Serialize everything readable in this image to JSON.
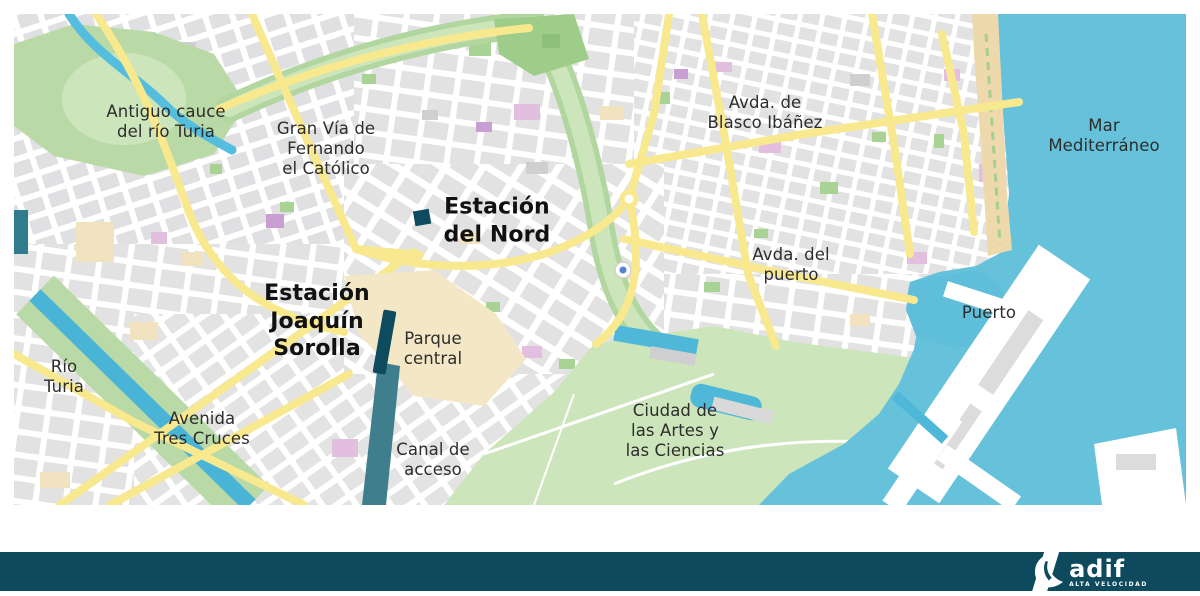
{
  "map": {
    "title": "Mapa de Valencia: estaciones Adif",
    "labels": [
      {
        "id": "antiguo-cauce-del-rio-turia",
        "text": "Antiguo cauce\ndel río Turia",
        "x": 152,
        "y": 108,
        "bold": false
      },
      {
        "id": "gran-via-fernando-el-catolico",
        "text": "Gran Vía de\nFernando\nel Católico",
        "x": 312,
        "y": 135,
        "bold": false
      },
      {
        "id": "estacion-del-nord",
        "text": "Estación\ndel Nord",
        "x": 483,
        "y": 207,
        "bold": true
      },
      {
        "id": "avda-de-blasco-ibanez",
        "text": "Avda. de\nBlasco Ibáñez",
        "x": 751,
        "y": 99,
        "bold": false
      },
      {
        "id": "mar-mediterraneo",
        "text": "Mar\nMediterráneo",
        "x": 1090,
        "y": 122,
        "bold": false
      },
      {
        "id": "estacion-joaquin-sorolla",
        "text": "Estación\nJoaquín\nSorolla",
        "x": 303,
        "y": 307,
        "bold": true
      },
      {
        "id": "parque-central",
        "text": "Parque\ncentral",
        "x": 419,
        "y": 335,
        "bold": false
      },
      {
        "id": "avda-del-puerto",
        "text": "Avda. del\npuerto",
        "x": 777,
        "y": 251,
        "bold": false
      },
      {
        "id": "puerto",
        "text": "Puerto",
        "x": 975,
        "y": 299,
        "bold": false
      },
      {
        "id": "rio-turia",
        "text": "Río\nTuria",
        "x": 50,
        "y": 363,
        "bold": false
      },
      {
        "id": "avenida-tres-cruces",
        "text": "Avenida\nTres Cruces",
        "x": 188,
        "y": 415,
        "bold": false
      },
      {
        "id": "canal-de-acceso",
        "text": "Canal de\nacceso",
        "x": 419,
        "y": 446,
        "bold": false
      },
      {
        "id": "ciudad-de-las-artes",
        "text": "Ciudad de\nlas Artes y\nlas Ciencias",
        "x": 661,
        "y": 417,
        "bold": false
      }
    ],
    "colors": {
      "sea": "#66c1db",
      "harbor_water": "#5fbeda",
      "beach_sand": "#eed9ad",
      "park_green": "#b9d9a7",
      "park_light_green": "#cde5bb",
      "dense_green": "#9ecd8a",
      "city_block_gray": "#e2e2e3",
      "building_dark_gray": "#cfcfd1",
      "major_road_yellow": "#f8e88e",
      "special_building_pink": "#e3bfdf",
      "special_building_purple": "#c99fd3",
      "beige_zone": "#f2e3c0",
      "rail_corridor_beige": "#f3e7c6",
      "station_dark_teal": "#0e4b5e",
      "access_canal_teal": "#3f7e8d",
      "river_blue": "#49b4d6",
      "footer_bar": "#0d4a5e",
      "label_text": "#2d2d2d"
    }
  },
  "footer": {
    "brand": "adif",
    "tagline": "ALTA VELOCIDAD"
  }
}
